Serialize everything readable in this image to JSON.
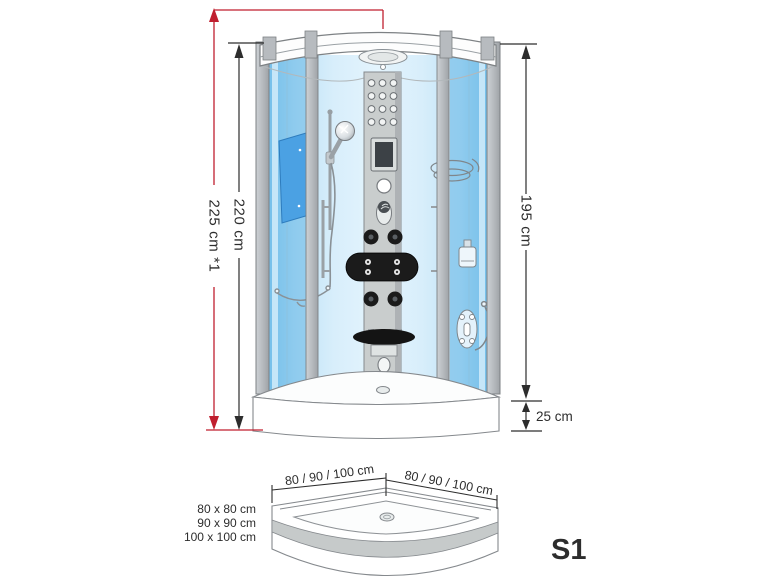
{
  "diagram": {
    "front_view": {
      "total_height_label": "225 cm *1",
      "inner_height_label": "220 cm",
      "glass_height_label": "195 cm",
      "tray_height_label": "25 cm"
    },
    "top_view": {
      "left_width_label": "80 / 90 / 100 cm",
      "right_width_label": "80 / 90 / 100 cm",
      "size_options": [
        "80 x 80 cm",
        "90 x 90 cm",
        "100 x 100 cm"
      ]
    },
    "model_label": "S1",
    "colors": {
      "accent_red": "#c01f2f",
      "dimension_black": "#2d2d2d",
      "glass_blue": "#bfe3f6",
      "glass_deep_blue": "#74bfe9",
      "frame_gray": "#b7bbbf",
      "jet_black": "#1b1b1b"
    }
  }
}
